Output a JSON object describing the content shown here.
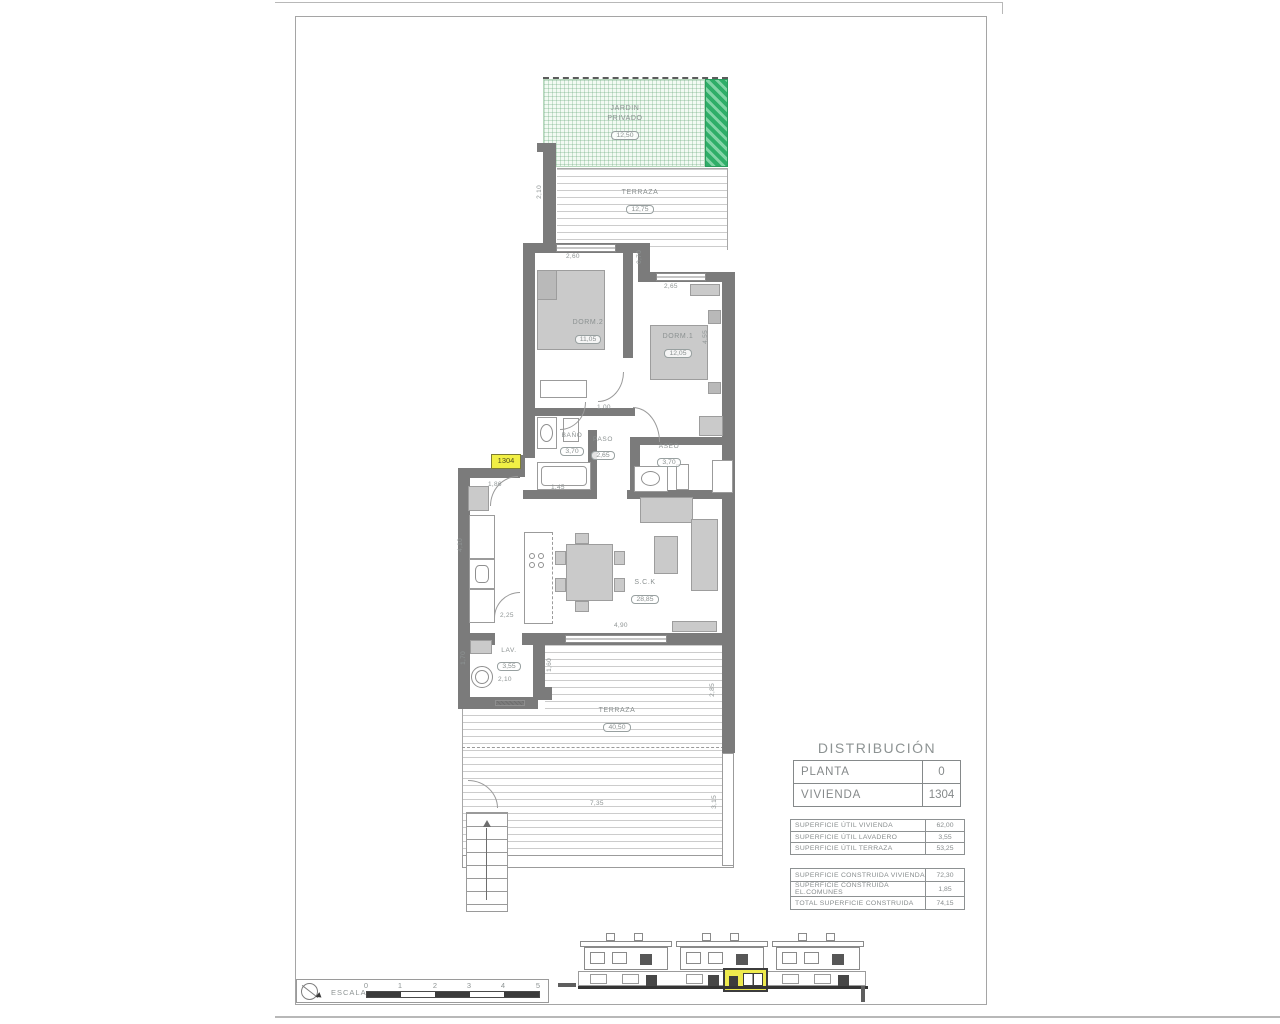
{
  "plan": {
    "unit_tag": "1304",
    "rooms": [
      {
        "name": "JARDIN PRIVADO",
        "area": "12,50"
      },
      {
        "name": "TERRAZA",
        "area": "12,75"
      },
      {
        "name": "DORM.2",
        "area": "11,05"
      },
      {
        "name": "DORM.1",
        "area": "12,05"
      },
      {
        "name": "BAÑO",
        "area": "3,70"
      },
      {
        "name": "PASO",
        "area": "2,65"
      },
      {
        "name": "ASEO",
        "area": "3,70"
      },
      {
        "name": "S.C.K",
        "area": "28,85"
      },
      {
        "name": "LAV.",
        "area": "3,55"
      },
      {
        "name": "TERRAZA",
        "area": "40,50"
      }
    ],
    "dimensions": [
      "2,10",
      "2,60",
      "0,70",
      "2,65",
      "4,55",
      "1,00",
      "1,86",
      "1,45",
      "4,10",
      "2,25",
      "4,90",
      "1,70",
      "2,10",
      "1,60",
      "2,85",
      "7,35",
      "3,15"
    ]
  },
  "distribution": {
    "title": "DISTRIBUCIÓN",
    "info": [
      {
        "label": "PLANTA",
        "value": "0"
      },
      {
        "label": "VIVIENDA",
        "value": "1304"
      }
    ],
    "useful": [
      {
        "label": "SUPERFICIE ÚTIL VIVIENDA",
        "value": "62,00"
      },
      {
        "label": "SUPERFICIE ÚTIL LAVADERO",
        "value": "3,55"
      },
      {
        "label": "SUPERFICIE ÚTIL TERRAZA",
        "value": "53,25"
      }
    ],
    "built": [
      {
        "label": "SUPERFICIE CONSTRUIDA VIVIENDA",
        "value": "72,30"
      },
      {
        "label": "SUPERFICIE CONSTRUIDA EL.COMUNES",
        "value": "1,85"
      },
      {
        "label": "TOTAL SUPERFICIE CONSTRUIDA",
        "value": "74,15"
      }
    ]
  },
  "scale": {
    "label": "ESCALA :",
    "ticks": [
      "0",
      "1",
      "2",
      "3",
      "4",
      "5"
    ]
  },
  "colors": {
    "wall_gray": "#7b7b7b",
    "garden_green": "#2fae68",
    "highlight_yellow": "#f1ef45"
  }
}
